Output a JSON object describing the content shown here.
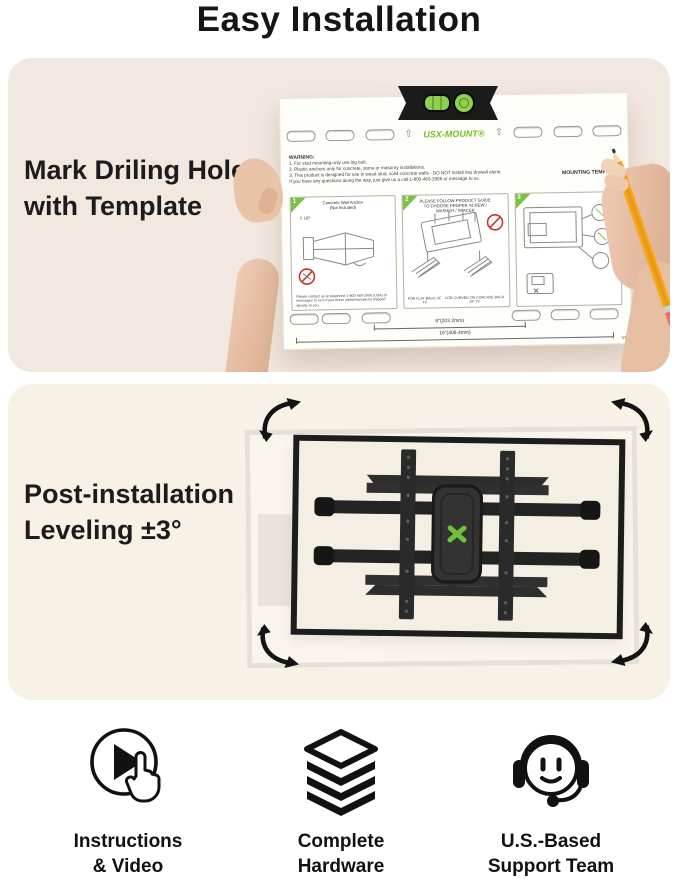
{
  "page": {
    "title": "Easy Installation"
  },
  "colors": {
    "panel1_bg": "#f1e8e0",
    "panel2_bg": "#f8f1e6",
    "brand_green": "#72c41e",
    "mount_dark": "#262626",
    "pencil_yellow": "#f2a41d"
  },
  "section1": {
    "heading1": "Mark Driling Holes",
    "heading2": "with Template",
    "template": {
      "brand": "USX-MOUNT",
      "label": "MOUNTING TEMPLATE",
      "warning_title": "WARNING:",
      "warning1": "1. For stud mounting only use lag bolt.",
      "warning2": "2. Plastic anchors only for concrete, stone or masonry installations.",
      "warning3": "3. This product is designed for use in wood stud, solid concrete walls - DO NOT install into drywall alone.",
      "warning4": "If you have any questions along the way, just give us a call 1-800-460-2906 or message to us.",
      "step1": {
        "num": "1",
        "title1": "Concrete Wall Anchor",
        "title2": "(Not Included)",
        "up": "UP",
        "note": "Please contact us at telephone 1-800-460-2906 (USA) or messages to us to have these additional pieces shipped directly to you."
      },
      "step2": {
        "num": "2",
        "title": "PLEASE FOLLOW PRODUCT GUIDE TO CHOOSE PROPER SCREW / WASHER / SPACER",
        "cap1": "FOR FLAT BACK OF TV",
        "cap2": "FOR CURVED OR CONCAVE BACK OF TV"
      },
      "step3": {
        "num": "3"
      },
      "dims": {
        "small": "8\"(203.2mm)",
        "large": "16\"(406.4mm)",
        "version": "V9"
      }
    }
  },
  "section2": {
    "heading1": "Post-installation",
    "heading2": "Leveling ±3°"
  },
  "features": [
    {
      "icon": "play-video-icon",
      "line1": "Instructions",
      "line2": "& Video"
    },
    {
      "icon": "hardware-stack-icon",
      "line1": "Complete",
      "line2": "Hardware"
    },
    {
      "icon": "headset-support-icon",
      "line1": "U.S.-Based",
      "line2": "Support Team"
    }
  ]
}
